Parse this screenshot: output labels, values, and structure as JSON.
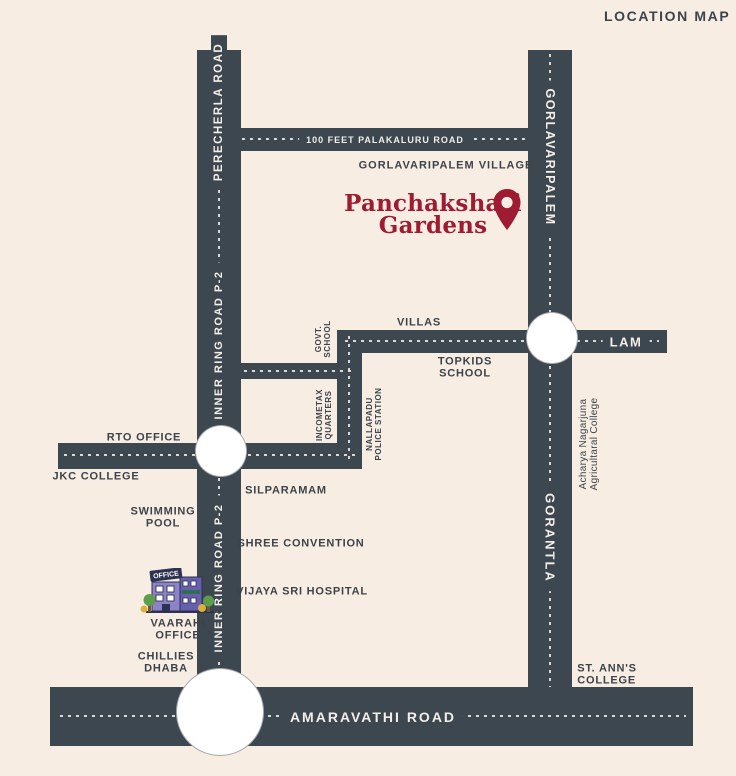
{
  "title": "LOCATION MAP",
  "colors": {
    "background": "#f8ede3",
    "road": "#3d4750",
    "road_text": "#f3efe8",
    "place_text": "#3c434b",
    "brand_red": "#9e1b31"
  },
  "brand": {
    "line1": "Panchakshari",
    "line2": "Gardens"
  },
  "road_labels": {
    "perecherla": "PERECHERLA ROAD",
    "inner_ring_upper": "INNER RING ROAD P-2",
    "inner_ring_lower": "INNER RING ROAD P-2",
    "gorlavaripalem": "GORLAVARIPALEM",
    "gorantla": "GORANTLA",
    "palakaluru": "100 FEET PALAKALURU ROAD",
    "lam": "LAM",
    "amaravathi": "AMARAVATHI ROAD"
  },
  "places": {
    "gorlavaripalem_village": "GORLAVARIPALEM VILLAGE",
    "villas": "VILLAS",
    "topkids_line1": "TOPKIDS",
    "topkids_line2": "SCHOOL",
    "govt_school_line1": "GOVT.",
    "govt_school_line2": "SCHOOL",
    "incometax_line1": "INCOMETAX",
    "incometax_line2": "QUARTERS",
    "nallapadu_line1": "NALLAPADU",
    "nallapadu_line2": "POLICE STATION",
    "rto_office": "RTO OFFICE",
    "jkc_college": "JKC COLLEGE",
    "silparamam": "SILPARAMAM",
    "swimming_line1": "SWIMMING",
    "swimming_line2": "POOL",
    "shree_convention": "SHREE CONVENTION",
    "vijaya_sri_hospital": "VIJAYA SRI HOSPITAL",
    "vaarahi_line1": "VAARAHI",
    "vaarahi_line2": "OFFICE",
    "chillies_line1": "CHILLIES",
    "chillies_line2": "DHABA",
    "st_anns_line1": "ST. ANN'S",
    "st_anns_line2": "COLLEGE",
    "acharya_line1": "Acharya Nagarjuna",
    "acharya_line2": "Agricultaral College"
  },
  "building": {
    "sign": "OFFICE"
  }
}
